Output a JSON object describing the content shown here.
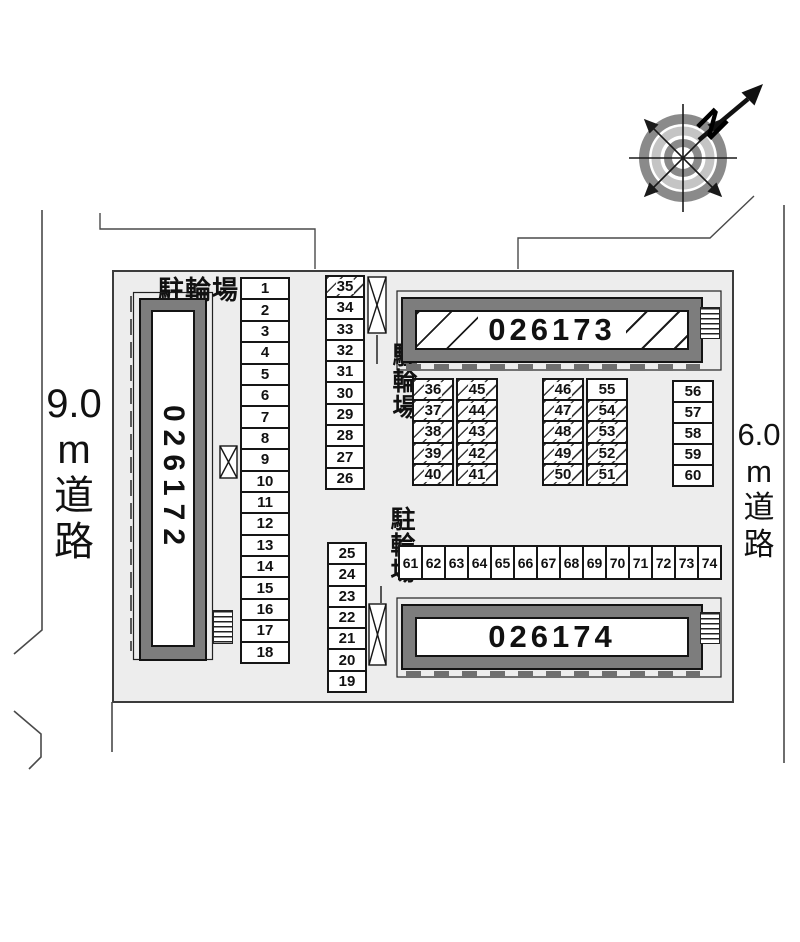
{
  "site_plan": {
    "bicycle_parking_labels": {
      "top": "駐輪場",
      "middle": "駐輪場",
      "lower": "駐輪場"
    },
    "roads": {
      "left": {
        "label": "9.0m道路",
        "lines": [
          "9.0",
          "m",
          "道",
          "路"
        ]
      },
      "right": {
        "label": "6.0m道路",
        "lines": [
          "6.0",
          "m",
          "道",
          "路"
        ]
      }
    },
    "compass": {
      "north": "N"
    },
    "buildings": {
      "b172": {
        "id": "026172"
      },
      "b173": {
        "id": "026173"
      },
      "b174": {
        "id": "026174"
      }
    },
    "colors": {
      "site_fill": "#ededed",
      "building_wall": "#7d7d7d",
      "line": "#161616"
    },
    "parking": {
      "col_left": [
        {
          "n": "1"
        },
        {
          "n": "2"
        },
        {
          "n": "3"
        },
        {
          "n": "4"
        },
        {
          "n": "5"
        },
        {
          "n": "6"
        },
        {
          "n": "7"
        },
        {
          "n": "8"
        },
        {
          "n": "9"
        },
        {
          "n": "10"
        },
        {
          "n": "11"
        },
        {
          "n": "12"
        },
        {
          "n": "13"
        },
        {
          "n": "14"
        },
        {
          "n": "15"
        },
        {
          "n": "16"
        },
        {
          "n": "17"
        },
        {
          "n": "18"
        }
      ],
      "col_mid_upper": [
        {
          "n": "35",
          "h": true
        },
        {
          "n": "34"
        },
        {
          "n": "33"
        },
        {
          "n": "32"
        },
        {
          "n": "31"
        },
        {
          "n": "30"
        },
        {
          "n": "29"
        },
        {
          "n": "28"
        },
        {
          "n": "27"
        },
        {
          "n": "26"
        }
      ],
      "col_mid_lower": [
        {
          "n": "25"
        },
        {
          "n": "24"
        },
        {
          "n": "23"
        },
        {
          "n": "22"
        },
        {
          "n": "21"
        },
        {
          "n": "20"
        },
        {
          "n": "19"
        }
      ],
      "block_a_left": [
        {
          "n": "36",
          "h": true
        },
        {
          "n": "37",
          "h": true
        },
        {
          "n": "38",
          "h": true
        },
        {
          "n": "39",
          "h": true
        },
        {
          "n": "40",
          "h": true
        }
      ],
      "block_a_right": [
        {
          "n": "45",
          "h": true
        },
        {
          "n": "44",
          "h": true
        },
        {
          "n": "43",
          "h": true
        },
        {
          "n": "42",
          "h": true
        },
        {
          "n": "41",
          "h": true
        }
      ],
      "block_b_left": [
        {
          "n": "46",
          "h": true
        },
        {
          "n": "47",
          "h": true
        },
        {
          "n": "48",
          "h": true
        },
        {
          "n": "49",
          "h": true
        },
        {
          "n": "50",
          "h": true
        }
      ],
      "block_b_right": [
        {
          "n": "55"
        },
        {
          "n": "54",
          "h": true
        },
        {
          "n": "53",
          "h": true
        },
        {
          "n": "52",
          "h": true
        },
        {
          "n": "51",
          "h": true
        }
      ],
      "col_right": [
        {
          "n": "56"
        },
        {
          "n": "57"
        },
        {
          "n": "58"
        },
        {
          "n": "59"
        },
        {
          "n": "60"
        }
      ],
      "row_bottom": [
        {
          "n": "61"
        },
        {
          "n": "62"
        },
        {
          "n": "63"
        },
        {
          "n": "64"
        },
        {
          "n": "65"
        },
        {
          "n": "66"
        },
        {
          "n": "67"
        },
        {
          "n": "68"
        },
        {
          "n": "69"
        },
        {
          "n": "70"
        },
        {
          "n": "71"
        },
        {
          "n": "72"
        },
        {
          "n": "73"
        },
        {
          "n": "74"
        }
      ]
    }
  }
}
